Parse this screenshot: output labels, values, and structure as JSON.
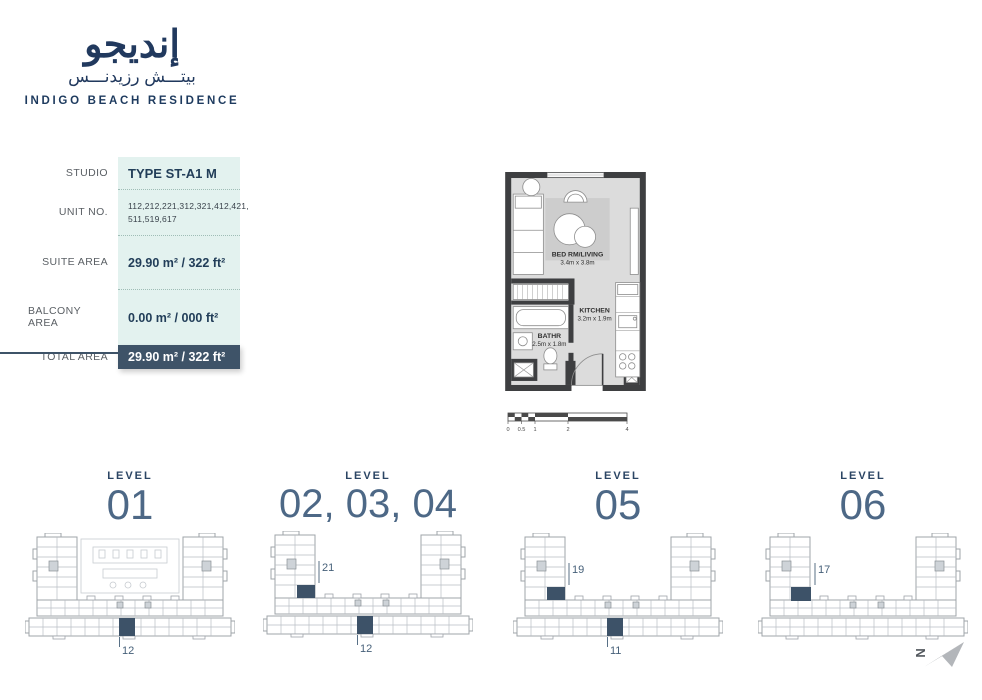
{
  "brand": {
    "logo_ar_main": "إنديجو",
    "logo_ar_sub": "بيتـــش رزيدنـــس",
    "logo_en": "INDIGO BEACH RESIDENCE"
  },
  "unit_info": {
    "rows": [
      {
        "label": "STUDIO",
        "value": "TYPE ST-A1 M"
      },
      {
        "label": "UNIT NO.",
        "value": "112,212,221,312,321,412,421,\n511,519,617"
      },
      {
        "label": "SUITE AREA",
        "value": "29.90 m² / 322 ft²"
      },
      {
        "label": "BALCONY AREA",
        "value": "0.00 m² / 000 ft²"
      },
      {
        "label": "TOTAL AREA",
        "value": "29.90 m² / 322 ft²"
      }
    ]
  },
  "floor_plan": {
    "rooms": [
      {
        "name": "BED RM/LIVING",
        "dims": "3.4m x 3.8m"
      },
      {
        "name": "KITCHEN",
        "dims": "3.2m x 1.9m"
      },
      {
        "name": "BATHR",
        "dims": "2.5m x 1.8m"
      }
    ]
  },
  "scale_bar": {
    "ticks": [
      "0",
      "0.5",
      "1",
      "2",
      "4"
    ]
  },
  "levels": [
    {
      "title": "LEVEL",
      "number": "01",
      "units": [
        {
          "id": "12"
        }
      ]
    },
    {
      "title": "LEVEL",
      "number": "02, 03, 04",
      "units": [
        {
          "id": "21"
        },
        {
          "id": "12"
        }
      ]
    },
    {
      "title": "LEVEL",
      "number": "05",
      "units": [
        {
          "id": "19"
        },
        {
          "id": "11"
        }
      ]
    },
    {
      "title": "LEVEL",
      "number": "06",
      "units": [
        {
          "id": "17"
        }
      ]
    }
  ],
  "compass": {
    "label": "N"
  },
  "colors": {
    "brand_navy": "#21395e",
    "table_bg": "#e3f2ef",
    "table_dark_row": "#3e5368",
    "unit_highlight": "#3d5268",
    "plan_wall": "#3e3f41"
  }
}
